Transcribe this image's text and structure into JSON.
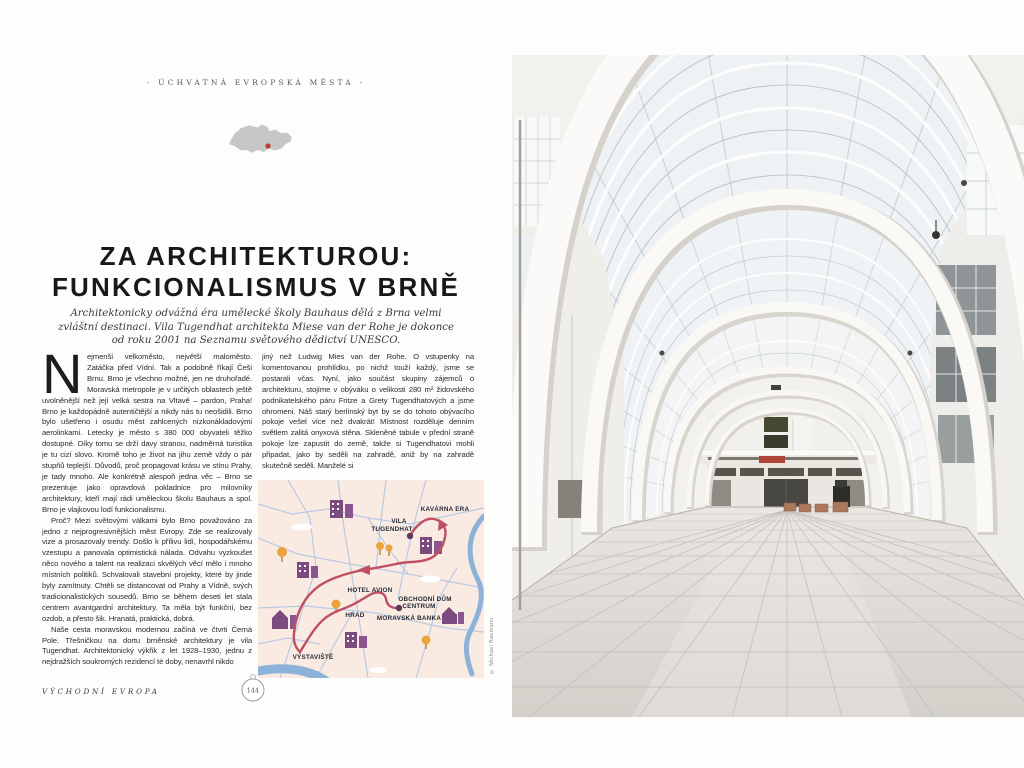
{
  "spread": {
    "section_header": "- ÚCHVATNÁ EVROPSKÁ MĚSTA -",
    "title_line1": "ZA ARCHITEKTUROU:",
    "title_line2": "FUNKCIONALISMUS V BRNĚ",
    "subtitle": "Architektonicky odvážná éra umělecké školy Bauhaus dělá z Brna velmi zvláštní destinaci. Vila Tugendhat architekta Miese van der Rohe je dokonce od roku 2001 na Seznamu světového dědictví UNESCO.",
    "footer_section": "VÝCHODNÍ EVROPA",
    "page_number": "144",
    "photo_credit": "© Michael Baumann"
  },
  "article": {
    "dropcap": "N",
    "col1": [
      "ejmenší velkoměsto, největší maloměsto. Zatáčka před Vídní. Tak a podobně říkají Češi Brnu. Brno je všechno možné, jen ne druhořadé. Moravská metropole je v určitých oblastech ještě uvolněnější než její velká sestra na Vltavě – pardon, Praha! Brno je každopádně autentičtější a nikdy nás tu neošidili. Brno bylo ušetřeno i osudu měst zahlcených nízkonákladovými aerolinkami. Letecky je město s 380 000 obyvateli těžko dostupné. Díky tomu se drží davy stranou, nadměrná turistika je tu cizí slovo. Kromě toho je život na jihu země vždy o pár stupňů teplejší. Důvodů, proč propagovat krásu ve stínu Prahy, je tady mnoho. Ale konkrétně alespoň jedna věc – Brno se prezentuje jako opravdová pokladnice pro milovníky architektury, kteří mají rádi uměleckou školu Bauhaus a spol. Brno je vlajkovou lodí funkcionalismu.",
      "Proč? Mezi světovými válkami bylo Brno považováno za jedno z nejprogresivnějších měst Evropy. Zde se realizovaly vize a prosazovaly trendy. Došlo k přílivu lidí, hospodářskému vzestupu a panovala optimistická nálada. Odvahu vyzkoušet něco nového a talent na realizaci skvělých věcí mělo i mnoho místních politiků. Schvalovali stavební projekty, které by jinde byly zamítnuty. Chtěli se distancovat od Prahy a Vídně, svých tradicionalistických sousedů. Brno se během deseti let stala centrem avantgardní architektury. Ta měla být funkční, bez ozdob, a přesto šik. Hranatá, praktická, dobrá.",
      "Naše cesta moravskou modernou začíná ve čtvrti Černá Pole. Třešničkou na dortu brněnské architektury je vila Tugendhat. Architektonický výkřik z let 1928–1930, jednu z nejdražších soukromých rezidencí té doby, nenavrhl nikdo"
    ],
    "col2": [
      "jiný než Ludwig Mies van der Rohe. O vstupenky na komentovanou prohlídku, po nichž touží každý, jsme se postarali včas. Nyní, jako součást skupiny zájemců o architekturu, stojíme v obýváku o velikosti 280 m² židovského podnikatelského páru Fritze a Grety Tugendhatových a jsme ohromeni. Náš starý berlínský byt by se do tohoto obývacího pokoje vešel více než dvakrát! Místnost rozděluje denním světlem zalitá onyxová stěna. Skleněné tabule v přední straně pokoje lze zapustit do země, takže si Tugendhatovi mohli připadat, jako by seděli na zahradě, aniž by na zahradě skutečně seděli. Manželé si"
    ]
  },
  "brno_map": {
    "labels": [
      "KAVÁRNA ERA",
      "VILA",
      "TUGENDHAT",
      "HOTEL AVION",
      "OBCHODNÍ DŮM",
      "CENTRUM",
      "HRAD",
      "MORAVSKÁ BANKA",
      "VÝSTAVIŠTĚ"
    ],
    "colors": {
      "background": "#f9ebe1",
      "roads": "#bac9e3",
      "river": "#8cb2da",
      "route": "#bf5063",
      "marker": "#5e3657",
      "buildings": "#7b4a7e",
      "trees": "#eba43c",
      "labels": "#262b38"
    }
  },
  "country_map": {
    "colors": {
      "country_fill": "#c6c5c7",
      "city_marker": "#c0392b"
    }
  }
}
